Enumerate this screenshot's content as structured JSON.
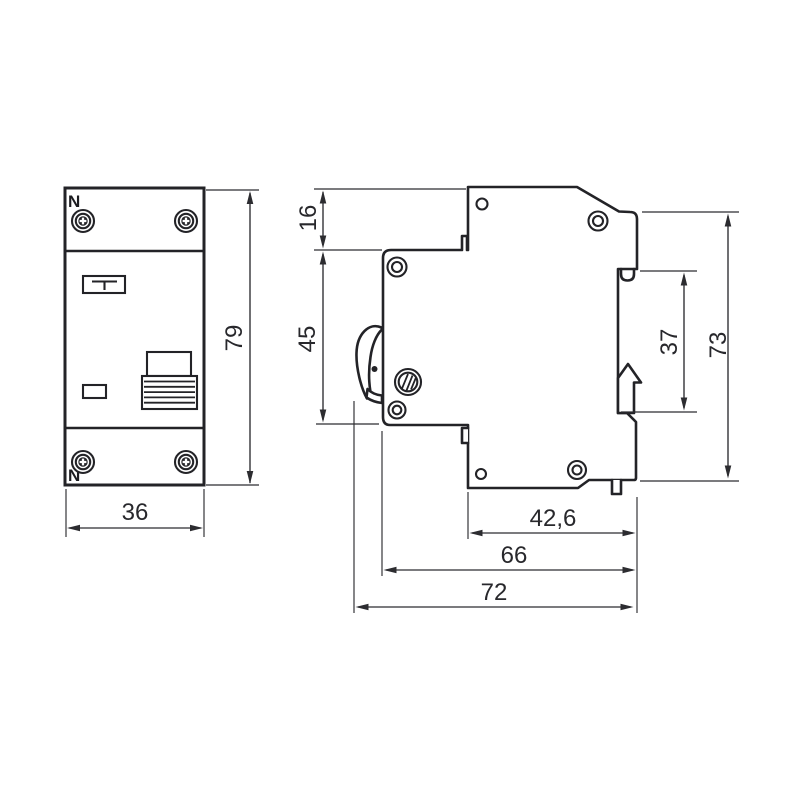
{
  "colors": {
    "line": "#232327",
    "dimension": "#2c2c30",
    "background": "#ffffff"
  },
  "front_view": {
    "neutral_top": "N",
    "neutral_bottom": "N",
    "height": "79",
    "width": "36"
  },
  "side_view": {
    "upper_section_height": "16",
    "front_section_height": "45",
    "din_slot_height": "37",
    "rear_height": "73",
    "terminal_depth": "42,6",
    "body_depth": "66",
    "overall_depth": "72"
  }
}
